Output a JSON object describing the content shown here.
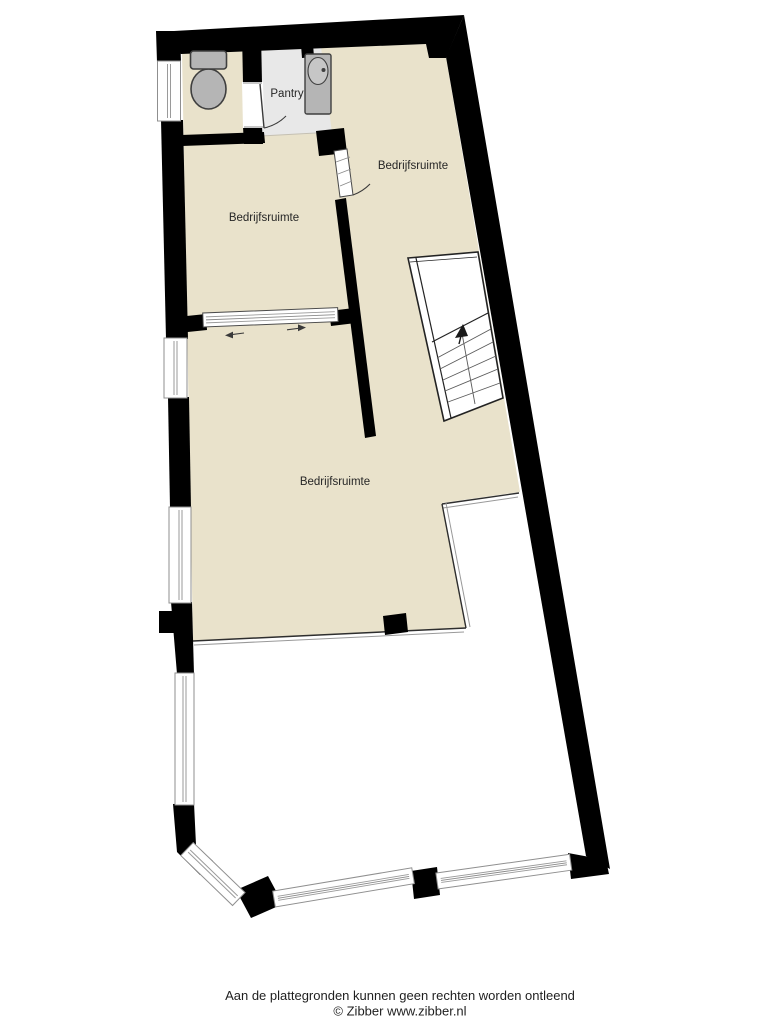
{
  "plan": {
    "rooms": [
      {
        "id": "pantry",
        "label": "Pantry"
      },
      {
        "id": "bedrijfsruimte-top-right",
        "label": "Bedrijfsruimte"
      },
      {
        "id": "bedrijfsruimte-middle-left",
        "label": "Bedrijfsruimte"
      },
      {
        "id": "bedrijfsruimte-bottom",
        "label": "Bedrijfsruimte"
      }
    ],
    "fixtures": [
      {
        "id": "toilet"
      },
      {
        "id": "sink"
      }
    ],
    "stairs": {
      "direction": "up"
    }
  },
  "footer": {
    "disclaimer": "Aan de plattegronden kunnen geen rechten worden ontleend",
    "credit": "© Zibber www.zibber.nl"
  },
  "colors": {
    "background": "#FFFFFF",
    "floor": "#E9E2CB",
    "pantry_floor": "#E8E8E8",
    "wall": "#000000",
    "fixture_fill": "#B5B5B5",
    "fixture_stroke": "#3F3F3F",
    "line": "#2E2E2E",
    "text": "#262626"
  }
}
